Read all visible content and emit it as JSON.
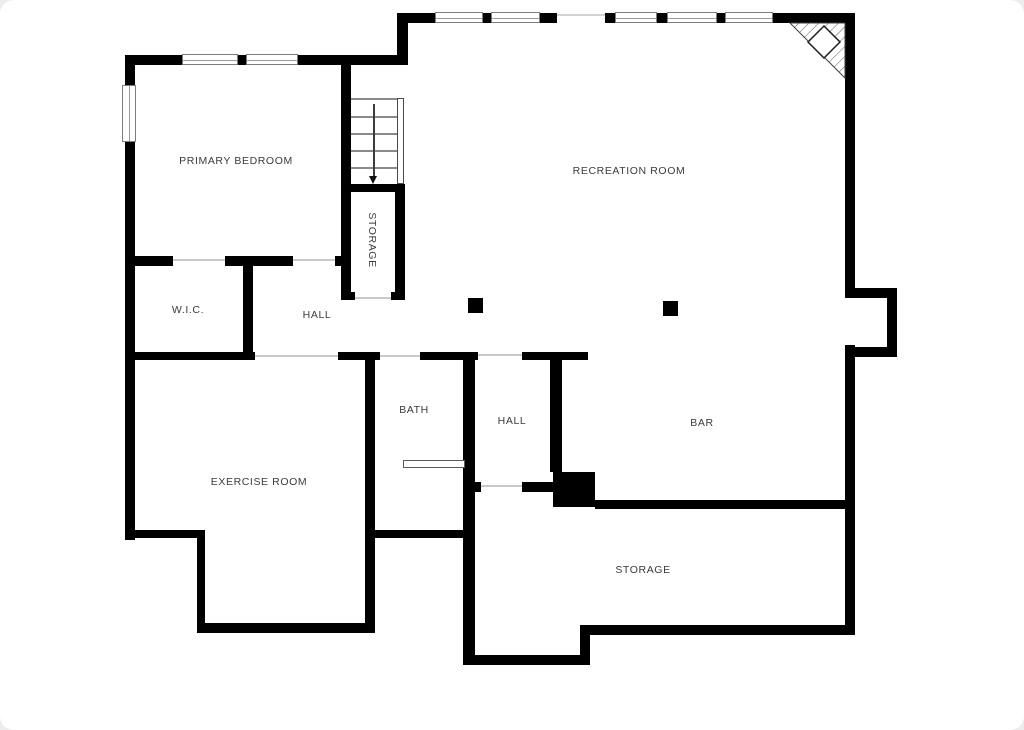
{
  "meta": {
    "title": "Basement floor plan",
    "colors": {
      "wall": "#000000",
      "thin_line": "#8a8a8a",
      "threshold": "#c9c9c9",
      "text": "#3b3b3b",
      "background": "#ffffff",
      "page_margin": "#ededed"
    }
  },
  "rooms": [
    {
      "id": "primary-bedroom",
      "label": "PRIMARY BEDROOM",
      "cx": 236,
      "cy": 161,
      "vertical": false
    },
    {
      "id": "recreation-room",
      "label": "RECREATION ROOM",
      "cx": 629,
      "cy": 171,
      "vertical": false
    },
    {
      "id": "storage-under-stairs",
      "label": "STORAGE",
      "cx": 372,
      "cy": 240,
      "vertical": true
    },
    {
      "id": "wic",
      "label": "W.I.C.",
      "cx": 188,
      "cy": 310,
      "vertical": false
    },
    {
      "id": "hall-upper",
      "label": "HALL",
      "cx": 317,
      "cy": 315,
      "vertical": false
    },
    {
      "id": "bath",
      "label": "BATH",
      "cx": 414,
      "cy": 410,
      "vertical": false
    },
    {
      "id": "hall-lower",
      "label": "HALL",
      "cx": 512,
      "cy": 421,
      "vertical": false
    },
    {
      "id": "bar",
      "label": "BAR",
      "cx": 702,
      "cy": 423,
      "vertical": false
    },
    {
      "id": "exercise-room",
      "label": "EXERCISE ROOM",
      "cx": 259,
      "cy": 482,
      "vertical": false
    },
    {
      "id": "storage-main",
      "label": "STORAGE",
      "cx": 643,
      "cy": 570,
      "vertical": false
    }
  ],
  "walls": [
    [
      125,
      55,
      57,
      10
    ],
    [
      238,
      55,
      8,
      10
    ],
    [
      298,
      55,
      110,
      10
    ],
    [
      397,
      13,
      11,
      48
    ],
    [
      400,
      13,
      35,
      10
    ],
    [
      483,
      13,
      8,
      10
    ],
    [
      540,
      13,
      17,
      10
    ],
    [
      605,
      13,
      10,
      10
    ],
    [
      657,
      13,
      10,
      10
    ],
    [
      717,
      13,
      8,
      10
    ],
    [
      773,
      13,
      72,
      10
    ],
    [
      125,
      55,
      10,
      30
    ],
    [
      125,
      142,
      10,
      398
    ],
    [
      845,
      13,
      10,
      285
    ],
    [
      845,
      345,
      10,
      290
    ],
    [
      845,
      288,
      52,
      10
    ],
    [
      887,
      288,
      10,
      69
    ],
    [
      855,
      347,
      42,
      10
    ],
    [
      125,
      256,
      48,
      10
    ],
    [
      225,
      256,
      68,
      10
    ],
    [
      335,
      256,
      8,
      10
    ],
    [
      243,
      262,
      10,
      92
    ],
    [
      125,
      352,
      130,
      8
    ],
    [
      338,
      352,
      42,
      8
    ],
    [
      420,
      352,
      58,
      8
    ],
    [
      522,
      352,
      66,
      8
    ],
    [
      341,
      63,
      10,
      237
    ],
    [
      341,
      184,
      64,
      8
    ],
    [
      395,
      184,
      10,
      116
    ],
    [
      341,
      292,
      14,
      8
    ],
    [
      391,
      292,
      14,
      8
    ],
    [
      365,
      352,
      10,
      281
    ],
    [
      463,
      352,
      12,
      313
    ],
    [
      475,
      482,
      6,
      10
    ],
    [
      550,
      352,
      12,
      120
    ],
    [
      522,
      482,
      31,
      10
    ],
    [
      368,
      530,
      100,
      8
    ],
    [
      125,
      530,
      80,
      8
    ],
    [
      197,
      530,
      8,
      103
    ],
    [
      197,
      623,
      176,
      10
    ],
    [
      465,
      655,
      125,
      10
    ],
    [
      580,
      625,
      10,
      40
    ],
    [
      590,
      625,
      265,
      10
    ],
    [
      595,
      500,
      250,
      9
    ]
  ],
  "black_boxes": [
    {
      "id": "mechanical-box",
      "rect": [
        553,
        472,
        42,
        35
      ]
    },
    {
      "id": "column",
      "rect": [
        468,
        298,
        15,
        15
      ]
    },
    {
      "id": "column",
      "rect": [
        663,
        301,
        15,
        15
      ]
    }
  ],
  "windows": [
    {
      "rect": [
        182,
        54,
        56,
        11
      ],
      "orient": "h"
    },
    {
      "rect": [
        246,
        54,
        52,
        11
      ],
      "orient": "h"
    },
    {
      "rect": [
        435,
        12,
        48,
        11
      ],
      "orient": "h"
    },
    {
      "rect": [
        491,
        12,
        49,
        11
      ],
      "orient": "h"
    },
    {
      "rect": [
        615,
        12,
        42,
        11
      ],
      "orient": "h"
    },
    {
      "rect": [
        667,
        12,
        50,
        11
      ],
      "orient": "h"
    },
    {
      "rect": [
        725,
        12,
        48,
        11
      ],
      "orient": "h"
    },
    {
      "rect": [
        122,
        85,
        14,
        57
      ],
      "orient": "v"
    }
  ],
  "thresholds": [
    [
      173,
      259,
      52
    ],
    [
      293,
      259,
      42
    ],
    [
      255,
      355,
      83
    ],
    [
      380,
      355,
      40
    ],
    [
      478,
      354,
      44
    ],
    [
      478,
      485,
      44
    ],
    [
      355,
      297,
      36
    ]
  ],
  "faint_lines": [
    [
      557,
      14,
      48,
      2
    ]
  ],
  "stairs": {
    "rect": [
      351,
      98,
      46,
      86
    ],
    "treads": [
      98,
      116,
      133,
      150,
      167
    ],
    "rail": [
      397,
      98,
      7,
      86
    ],
    "arrow": {
      "x": 373,
      "y1": 104,
      "y2": 176
    }
  },
  "vanity": {
    "rect": [
      403,
      460,
      62,
      8
    ]
  },
  "fireplace": {
    "triangle": [
      [
        790,
        23
      ],
      [
        845,
        23
      ],
      [
        845,
        78
      ]
    ],
    "diamond": {
      "cx": 824,
      "cy": 42,
      "r": 16
    }
  }
}
